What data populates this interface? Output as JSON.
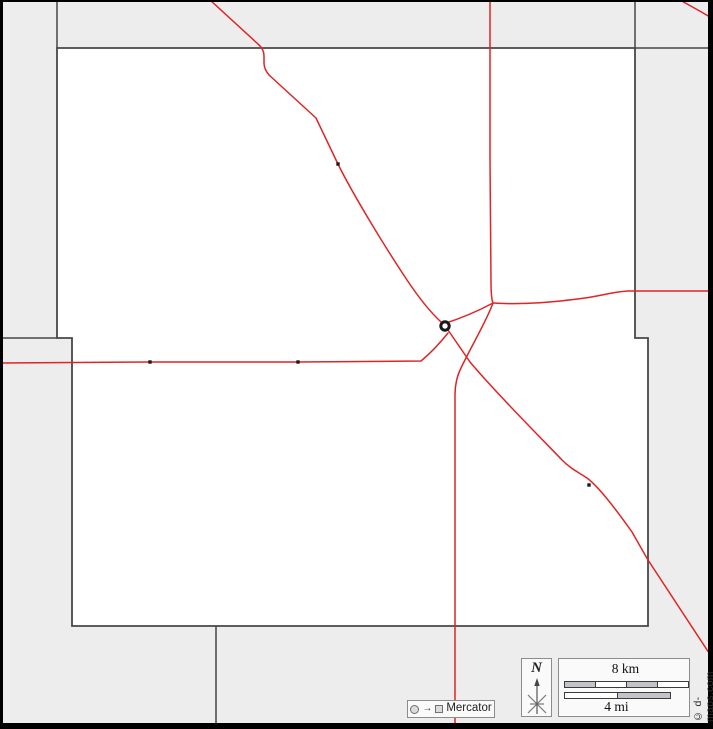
{
  "map": {
    "copyright": "© d-maps.com",
    "north": {
      "label": "N"
    },
    "scale": {
      "km_label": "8 km",
      "mi_label": "4 mi"
    },
    "projection": {
      "label": "Mercator",
      "arrow": "→"
    },
    "colors": {
      "background": "#ededed",
      "county_fill": "#ffffff",
      "boundary": "#474747",
      "frame": "#000000",
      "road": "#e02424",
      "marker": "#1a1a1a"
    },
    "cities": [
      {
        "x": 338,
        "y": 164
      },
      {
        "x": 150,
        "y": 362
      },
      {
        "x": 298,
        "y": 362
      },
      {
        "x": 589,
        "y": 485
      }
    ],
    "county_seat": {
      "x": 445,
      "y": 326
    }
  }
}
